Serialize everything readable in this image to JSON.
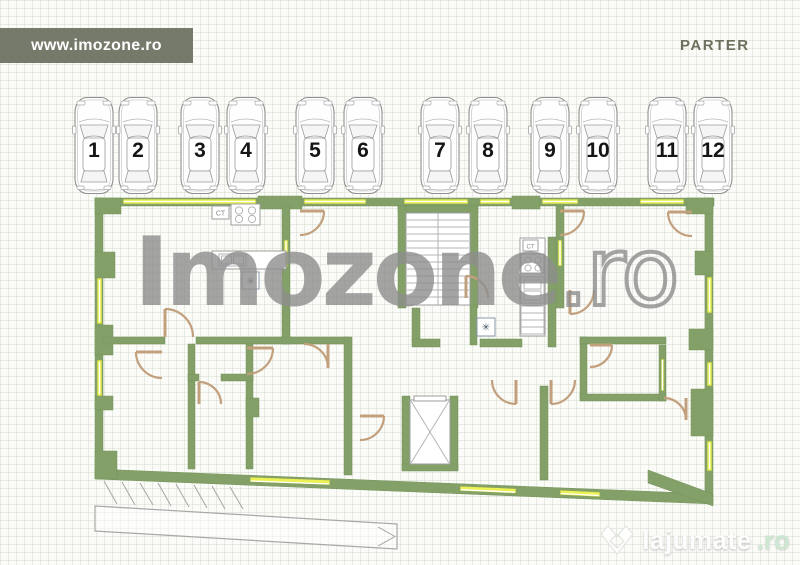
{
  "header": {
    "website_banner": "www.imozone.ro",
    "floor_label": "PARTER"
  },
  "parking": {
    "spaces": [
      "1",
      "2",
      "3",
      "4",
      "5",
      "6",
      "7",
      "8",
      "9",
      "10",
      "11",
      "12"
    ]
  },
  "floor_plan": {
    "boiler_label": "CT",
    "washer_symbol": "✳"
  },
  "watermark": {
    "brand": "Imozone",
    "suffix": ".ro"
  },
  "footer_logo": {
    "brand": "lajumate",
    "suffix": ".ro"
  },
  "colors": {
    "wall_green": "#84a069",
    "window_yellow": "#ecf154",
    "door_beige": "#c2a07e",
    "banner_bg": "#767a6b",
    "parter_text": "#6c705d"
  }
}
